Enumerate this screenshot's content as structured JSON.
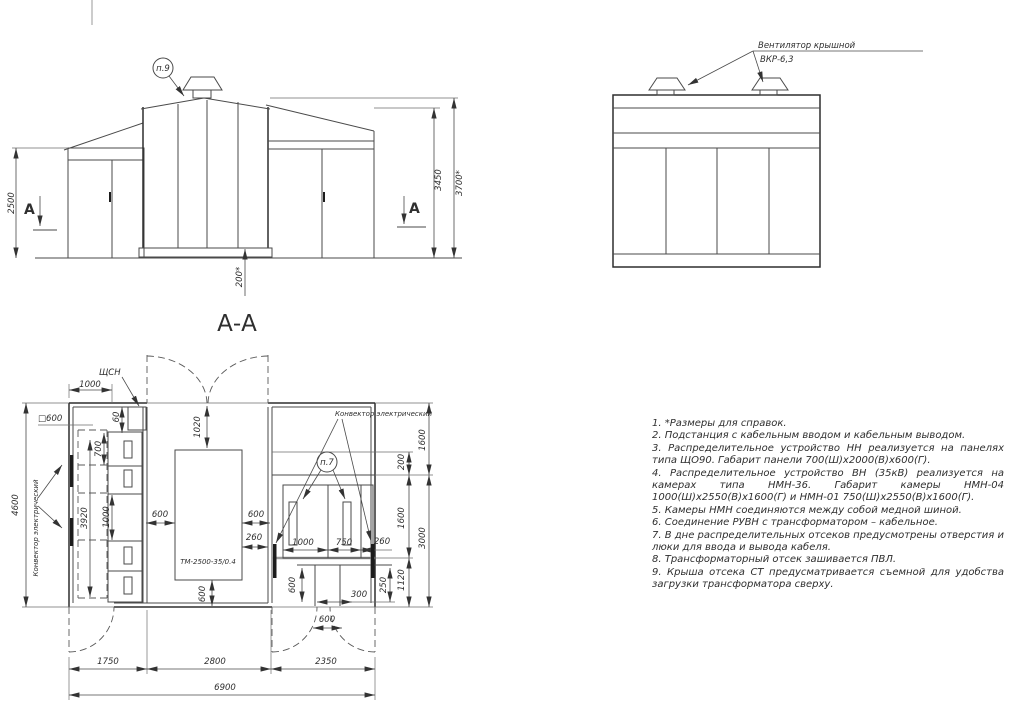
{
  "labels": {
    "section_view": "А-А",
    "section_marker": "А",
    "p9": "п.9",
    "p7": "п.7",
    "fan_line1": "Вентилятор крышной",
    "fan_line2": "ВКР-6,3",
    "schsn": "ЩСН",
    "convector": "Конвектор электрический",
    "transformer": "ТМ-2500-35/0.4",
    "square600": "□600"
  },
  "front_dims": {
    "height_left": "2500",
    "height_mid": "3450",
    "height_total": "3700*",
    "base": "200*"
  },
  "plan_dims": {
    "top_1000": "1000",
    "gap_60": "60",
    "v_700": "700",
    "v_3920": "3920",
    "v_1000": "1000",
    "h_total": "4600",
    "t_1020": "1020",
    "t_600_left": "600",
    "t_600_right": "600",
    "t_260": "260",
    "t_600_bottom": "600",
    "cam_1000": "1000",
    "cam_750": "750",
    "cam_260": "260",
    "niche_600": "600",
    "niche_300": "300",
    "r_250": "250",
    "r_1120": "1120",
    "r_200": "200",
    "r_1600_top": "1600",
    "r_1600_mid": "1600",
    "r_3000": "3000",
    "door_600": "600",
    "w_1750": "1750",
    "w_2800": "2800",
    "w_2350": "2350",
    "w_total": "6900"
  },
  "notes": [
    "1.  *Размеры для справок.",
    "2.  Подстанция с кабельным вводом и кабельным выводом.",
    "3.  Распределительное устройство НН реализуется на панелях типа ЩО90. Габарит панели 700(Ш)х2000(В)х600(Г).",
    "4.  Распределительное устройство ВН (35кВ) реализуется на камерах типа НМН-36. Габарит камеры НМН-04 1000(Ш)х2550(В)х1600(Г) и НМН-01 750(Ш)х2550(В)х1600(Г).",
    "5.  Камеры НМН соединяются между собой медной шиной.",
    "6.  Соединение РУВН с трансформатором – кабельное.",
    "7.  В дне распределительных отсеков предусмотрены отверстия и люки для ввода и вывода кабеля.",
    "8.  Трансформаторный отсек зашивается ПВЛ.",
    "9.  Крыша отсека СТ предусматривается съемной для удобства загрузки трансформатора сверху."
  ]
}
